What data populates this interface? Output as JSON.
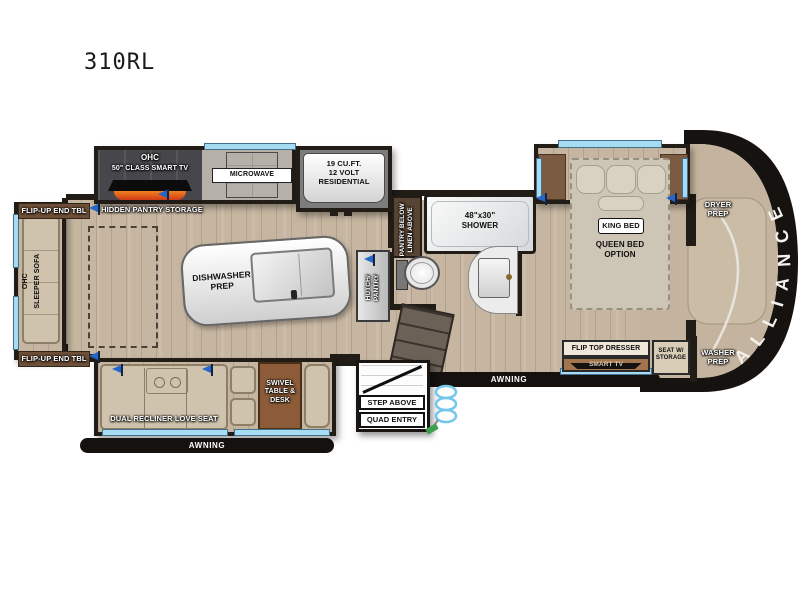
{
  "title": "310RL",
  "cap": {
    "brand": "ALLIANCE",
    "dryer": "DRYER\nPREP",
    "washer": "WASHER\nPREP"
  },
  "kitchen": {
    "ohc": "OHC",
    "tv": "50\" CLASS SMART TV",
    "microwave": "MICROWAVE",
    "fridge": "19 CU.FT.\n12 VOLT\nRESIDENTIAL",
    "hidden_pantry": "HIDDEN PANTRY STORAGE",
    "island": "DISHWASHER\nPREP",
    "hutch": "HUTCH/\nPANTRY"
  },
  "bath": {
    "pantry_linen": "PANTRY BELOW\nLINEN ABOVE",
    "shower": "48\"x30\"\nSHOWER"
  },
  "bedroom": {
    "king": "KING BED",
    "queen": "QUEEN BED\nOPTION",
    "dresser": "FLIP TOP DRESSER",
    "dresser_tv": "SMART TV",
    "seat": "SEAT W/\nSTORAGE"
  },
  "living": {
    "end_tbl_top": "FLIP-UP END TBL",
    "end_tbl_bottom": "FLIP-UP END TBL",
    "sofa_ohc": "OHC",
    "sofa": "SLEEPER SOFA",
    "loveseat": "DUAL RECLINER LOVE SEAT",
    "swivel": "SWIVEL\nTABLE &\nDESK"
  },
  "exterior": {
    "awning_left": "AWNING",
    "awning_right": "AWNING",
    "step": "STEP ABOVE",
    "entry": "QUAD ENTRY"
  },
  "colors": {
    "wall": "#221c16",
    "floor": "#c6b6a1",
    "window": "#a6dcf2",
    "flag": "#2766c9",
    "awning": "#15110e"
  }
}
